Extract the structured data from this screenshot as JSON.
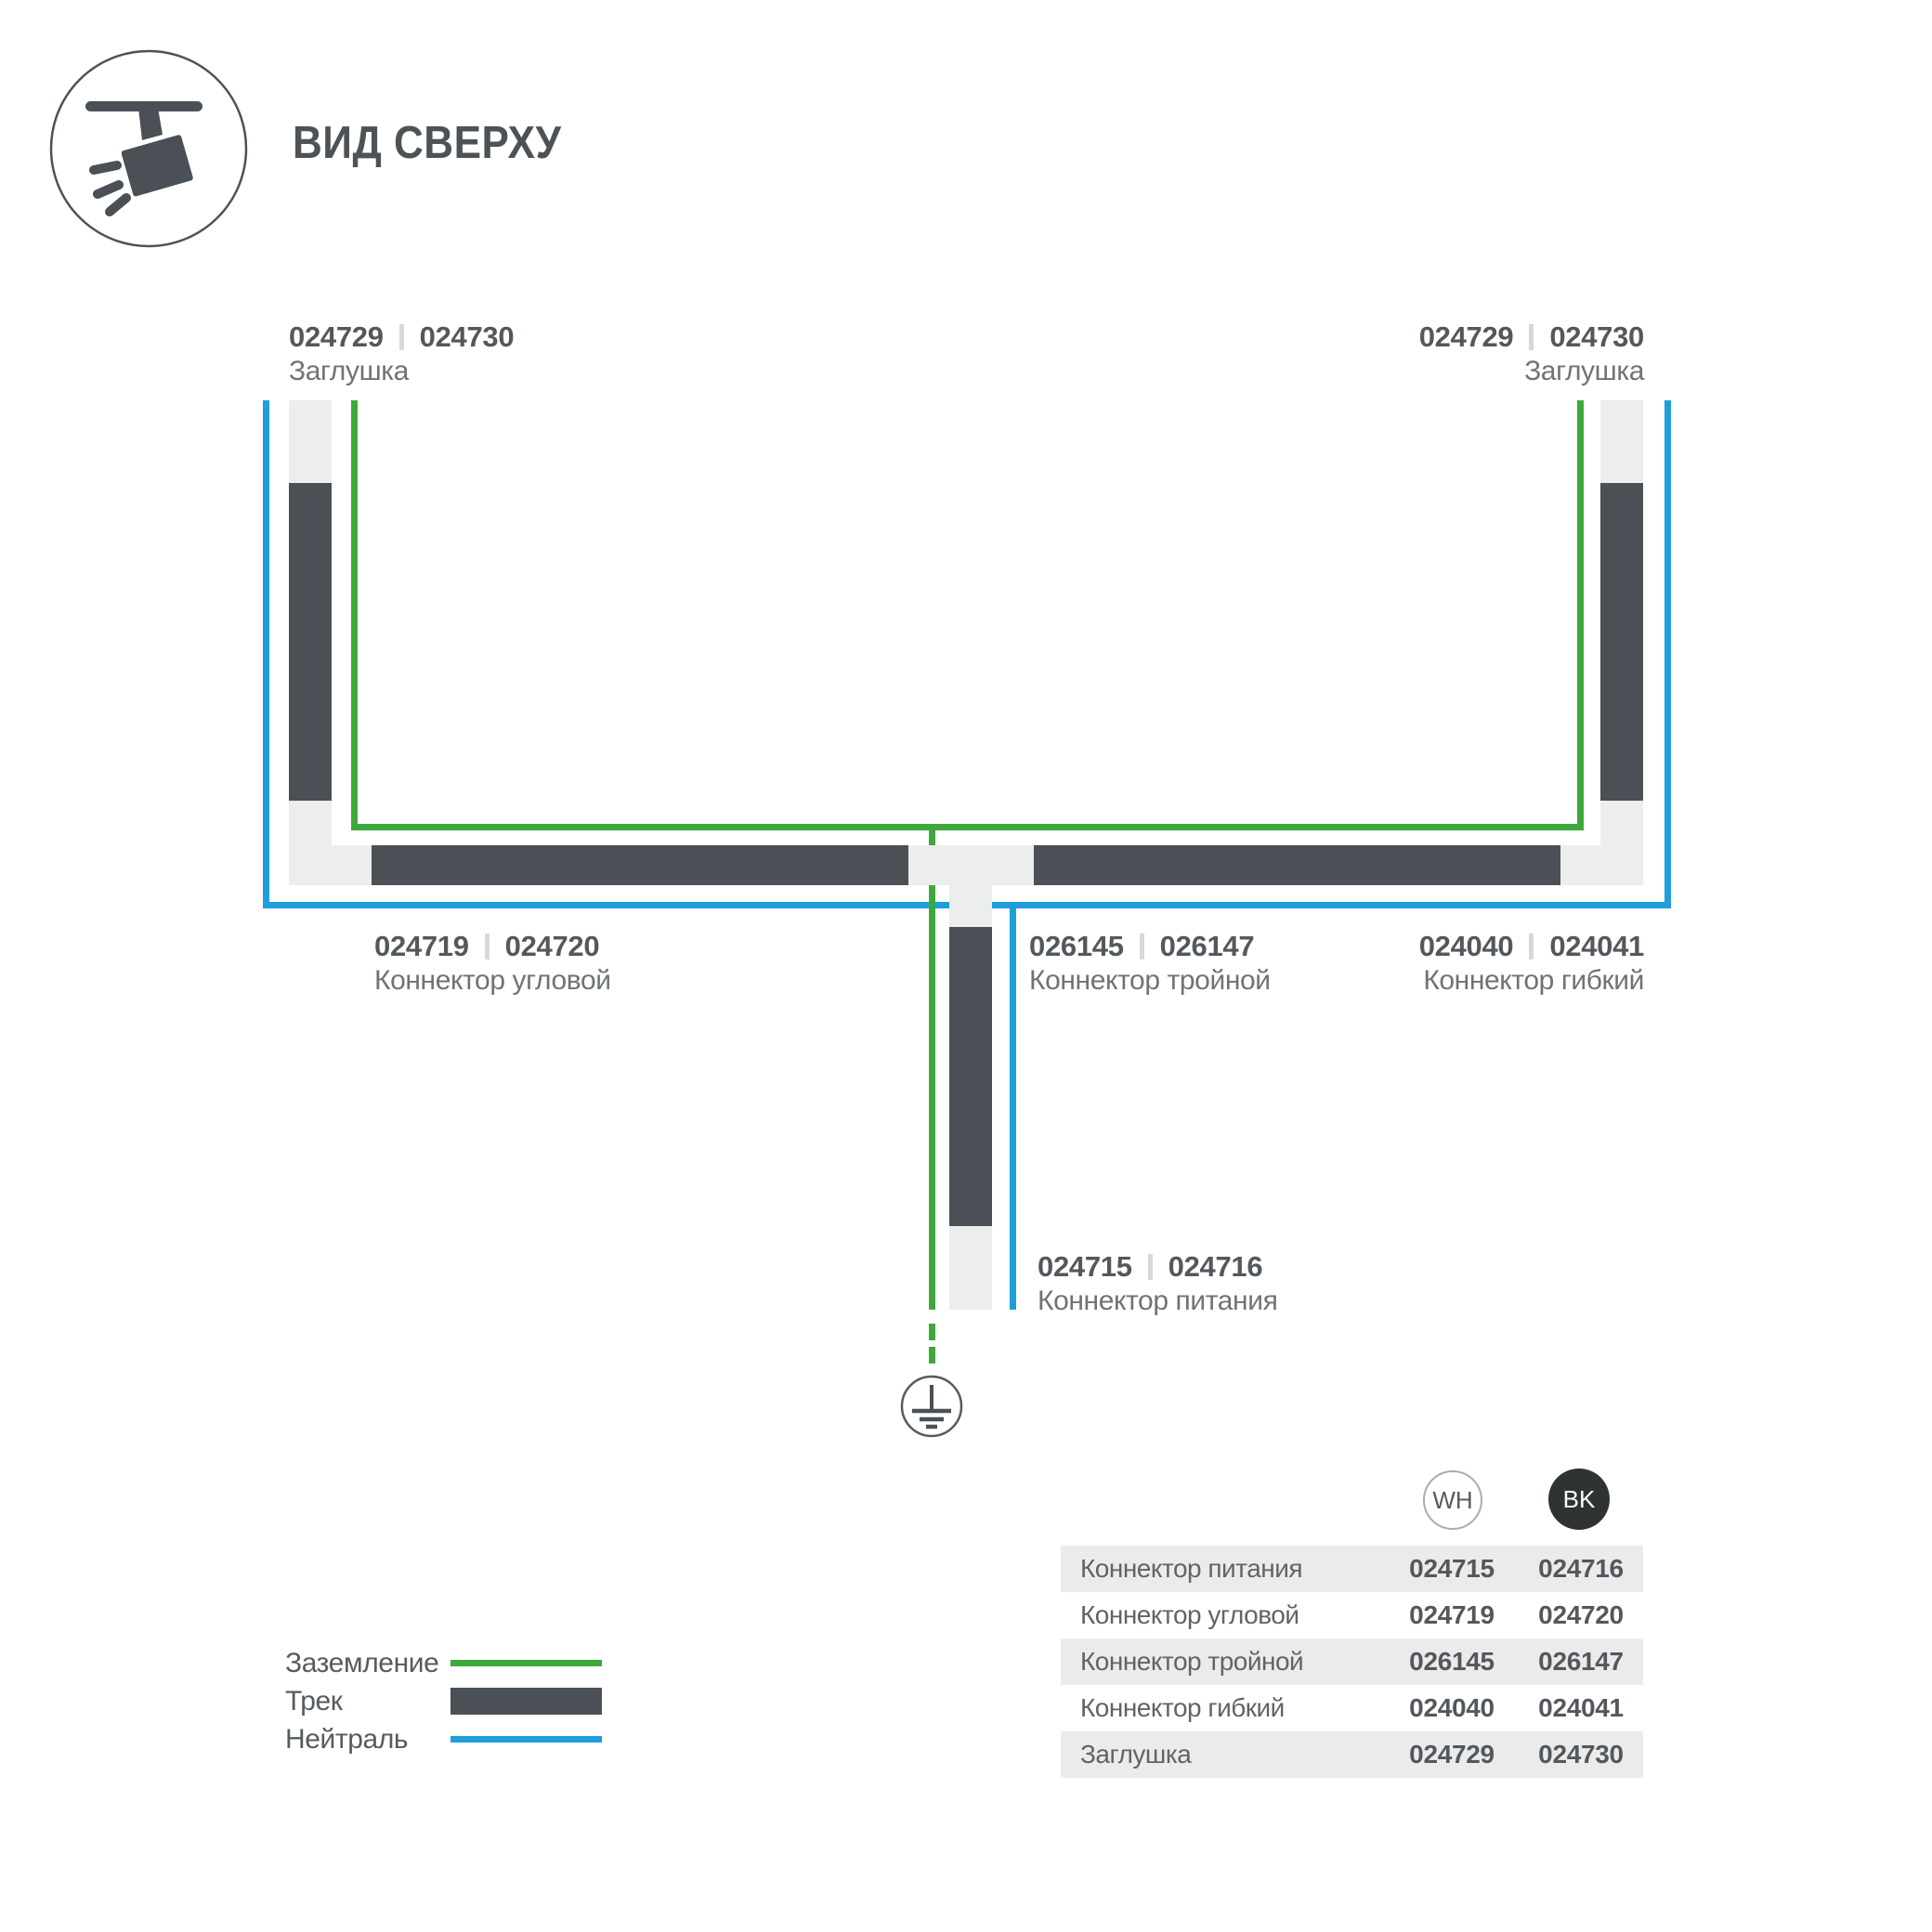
{
  "header": {
    "title": "ВИД СВЕРХУ",
    "icon": "ceiling-track-spotlight-icon"
  },
  "colors": {
    "ground_green": "#3FA83C",
    "neutral_blue": "#1E9FDB",
    "track_dark": "#4A5056",
    "connector_light": "#ECEDED",
    "table_row_gray": "#EBEBEB",
    "text_primary": "#53585D",
    "text_secondary": "#6E7377",
    "bk_badge": "#303334"
  },
  "diagram": {
    "ground_icon": "earth-ground-icon",
    "labels": {
      "cap_left": {
        "codes": [
          "024729",
          "024730"
        ],
        "name": "Заглушка"
      },
      "cap_right": {
        "codes": [
          "024729",
          "024730"
        ],
        "name": "Заглушка"
      },
      "corner": {
        "codes": [
          "024719",
          "024720"
        ],
        "name": "Коннектор угловой"
      },
      "triple": {
        "codes": [
          "026145",
          "026147"
        ],
        "name": "Коннектор тройной"
      },
      "flex": {
        "codes": [
          "024040",
          "024041"
        ],
        "name": "Коннектор гибкий"
      },
      "power": {
        "codes": [
          "024715",
          "024716"
        ],
        "name": "Коннектор питания"
      }
    }
  },
  "legend": {
    "items": [
      {
        "label": "Заземление",
        "swatch": "ground-line"
      },
      {
        "label": "Трек",
        "swatch": "track-bar"
      },
      {
        "label": "Нейтраль",
        "swatch": "neutral-line"
      }
    ]
  },
  "table": {
    "columns": [
      {
        "label": "WH"
      },
      {
        "label": "BK"
      }
    ],
    "rows": [
      {
        "label": "Коннектор питания",
        "wh": "024715",
        "bk": "024716"
      },
      {
        "label": "Коннектор угловой",
        "wh": "024719",
        "bk": "024720"
      },
      {
        "label": "Коннектор тройной",
        "wh": "026145",
        "bk": "026147"
      },
      {
        "label": "Коннектор гибкий",
        "wh": "024040",
        "bk": "024041"
      },
      {
        "label": "Заглушка",
        "wh": "024729",
        "bk": "024730"
      }
    ]
  }
}
